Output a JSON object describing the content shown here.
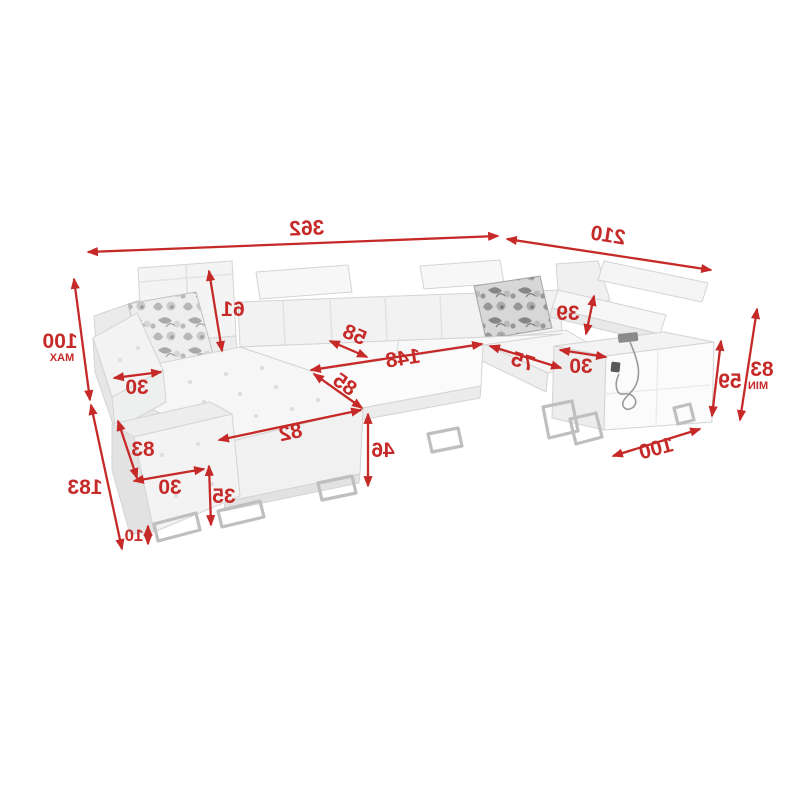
{
  "figure": {
    "kind": "product dimension diagram",
    "subject": "U-shaped corner sectional sofa with adjustable headrests, two floral pillows, metal sled legs and USB charging cable",
    "orientation": "horizontally mirrored drawing",
    "unit_note": "dimensions in centimetres (numbers only shown)"
  },
  "colors": {
    "dimension_red": "#c62a28",
    "background": "#ffffff",
    "sofa_light": "#f6f6f6",
    "sofa_mid": "#ededed",
    "sofa_dark": "#e3e3e3",
    "outline": "#d4d4d4",
    "metal_leg": "#bfbfbf"
  },
  "dims": {
    "total_width": "362",
    "section_depth_right": "210",
    "back_height_max": "100",
    "back_height_max_note": "MAX",
    "section_depth_left": "183",
    "headrest_height": "61",
    "armrest_width_left": "30",
    "storage_bench_height": "83",
    "storage_bench_width": "30",
    "base_height": "35",
    "leg_height": "10",
    "backrest_depth": "58",
    "seat_length_middle": "148",
    "chaise_seat_depth": "85",
    "chaise_width": "82",
    "seat_height": "46",
    "back_above_seat_right": "39",
    "armrest_width_right": "30",
    "corner_seat_width": "75",
    "armrest_height_right": "59",
    "back_height_min": "83",
    "back_height_min_note": "MIN",
    "armrest_module_length_right": "100"
  }
}
